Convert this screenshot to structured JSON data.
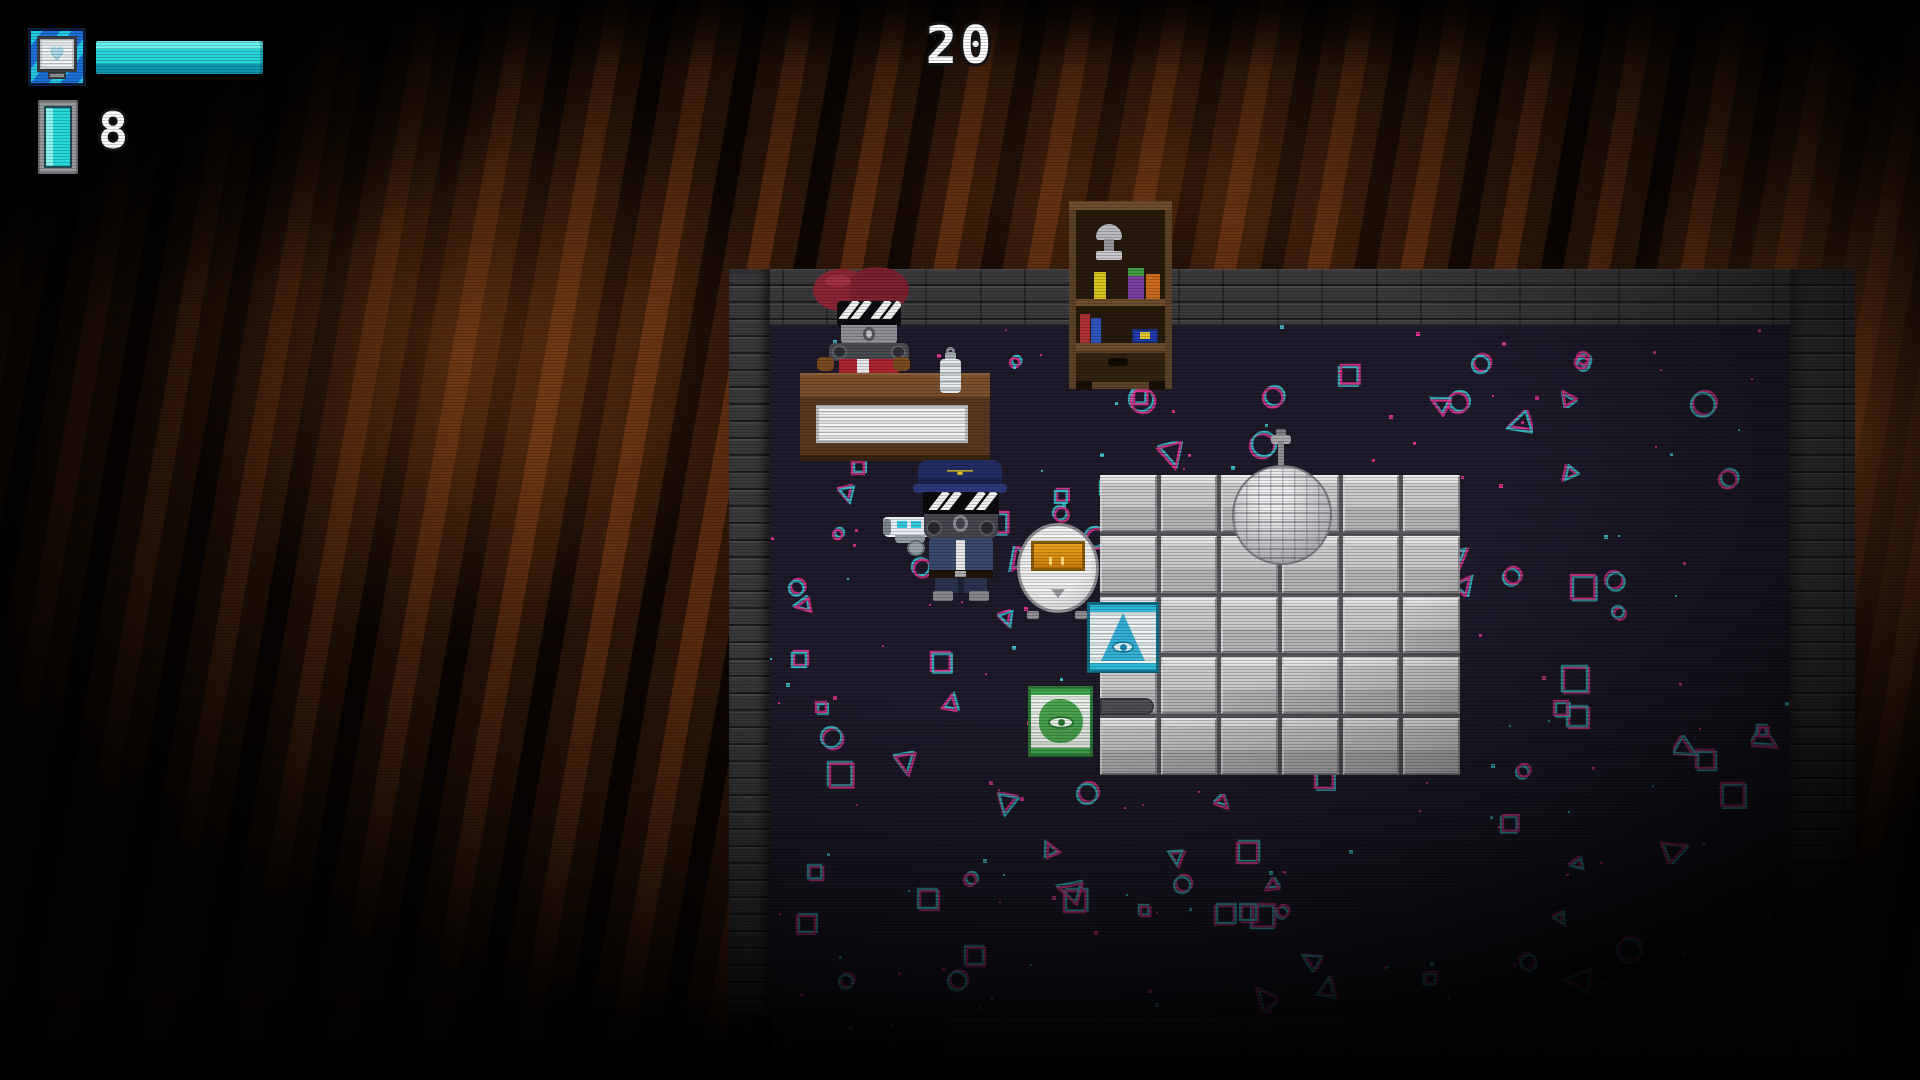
{
  "hud": {
    "timer": "20",
    "ammo_count": "8",
    "health": {
      "percent": 100,
      "bar_color": "#28d4dc",
      "icon": "heart-monitor-icon",
      "heart_glyph": "♥"
    },
    "ammo_icon": "energy-cell-icon",
    "text_color": "#ffffff"
  },
  "scene": {
    "room": {
      "floor_color": "#211d2e",
      "wall_color": "#3a3a3d",
      "pattern_colors": {
        "magenta": "#f0389b",
        "cyan": "#3fd0de"
      },
      "tile_grid": {
        "cols": 6,
        "rows": 5,
        "tile_color": "#c9c9cb"
      },
      "outside_glow_color": "#5a2b10"
    },
    "entities": {
      "shopkeeper": "masked shopkeeper with red hair behind wooden desk",
      "player": "police-capped masked character aiming blaster left",
      "bookshelf": "wooden bookshelf with trophy and colored books",
      "disco_ball": "mirror ball on stand over tiled floor",
      "round_machine": "white round machine with orange panel",
      "pyramid_sign": "cyan pyramid-eye floor sign",
      "green_sign": "green eye floor sign",
      "bottle": "white bottle on desk counter",
      "capsule": "grey capsule prop on tiles"
    }
  }
}
